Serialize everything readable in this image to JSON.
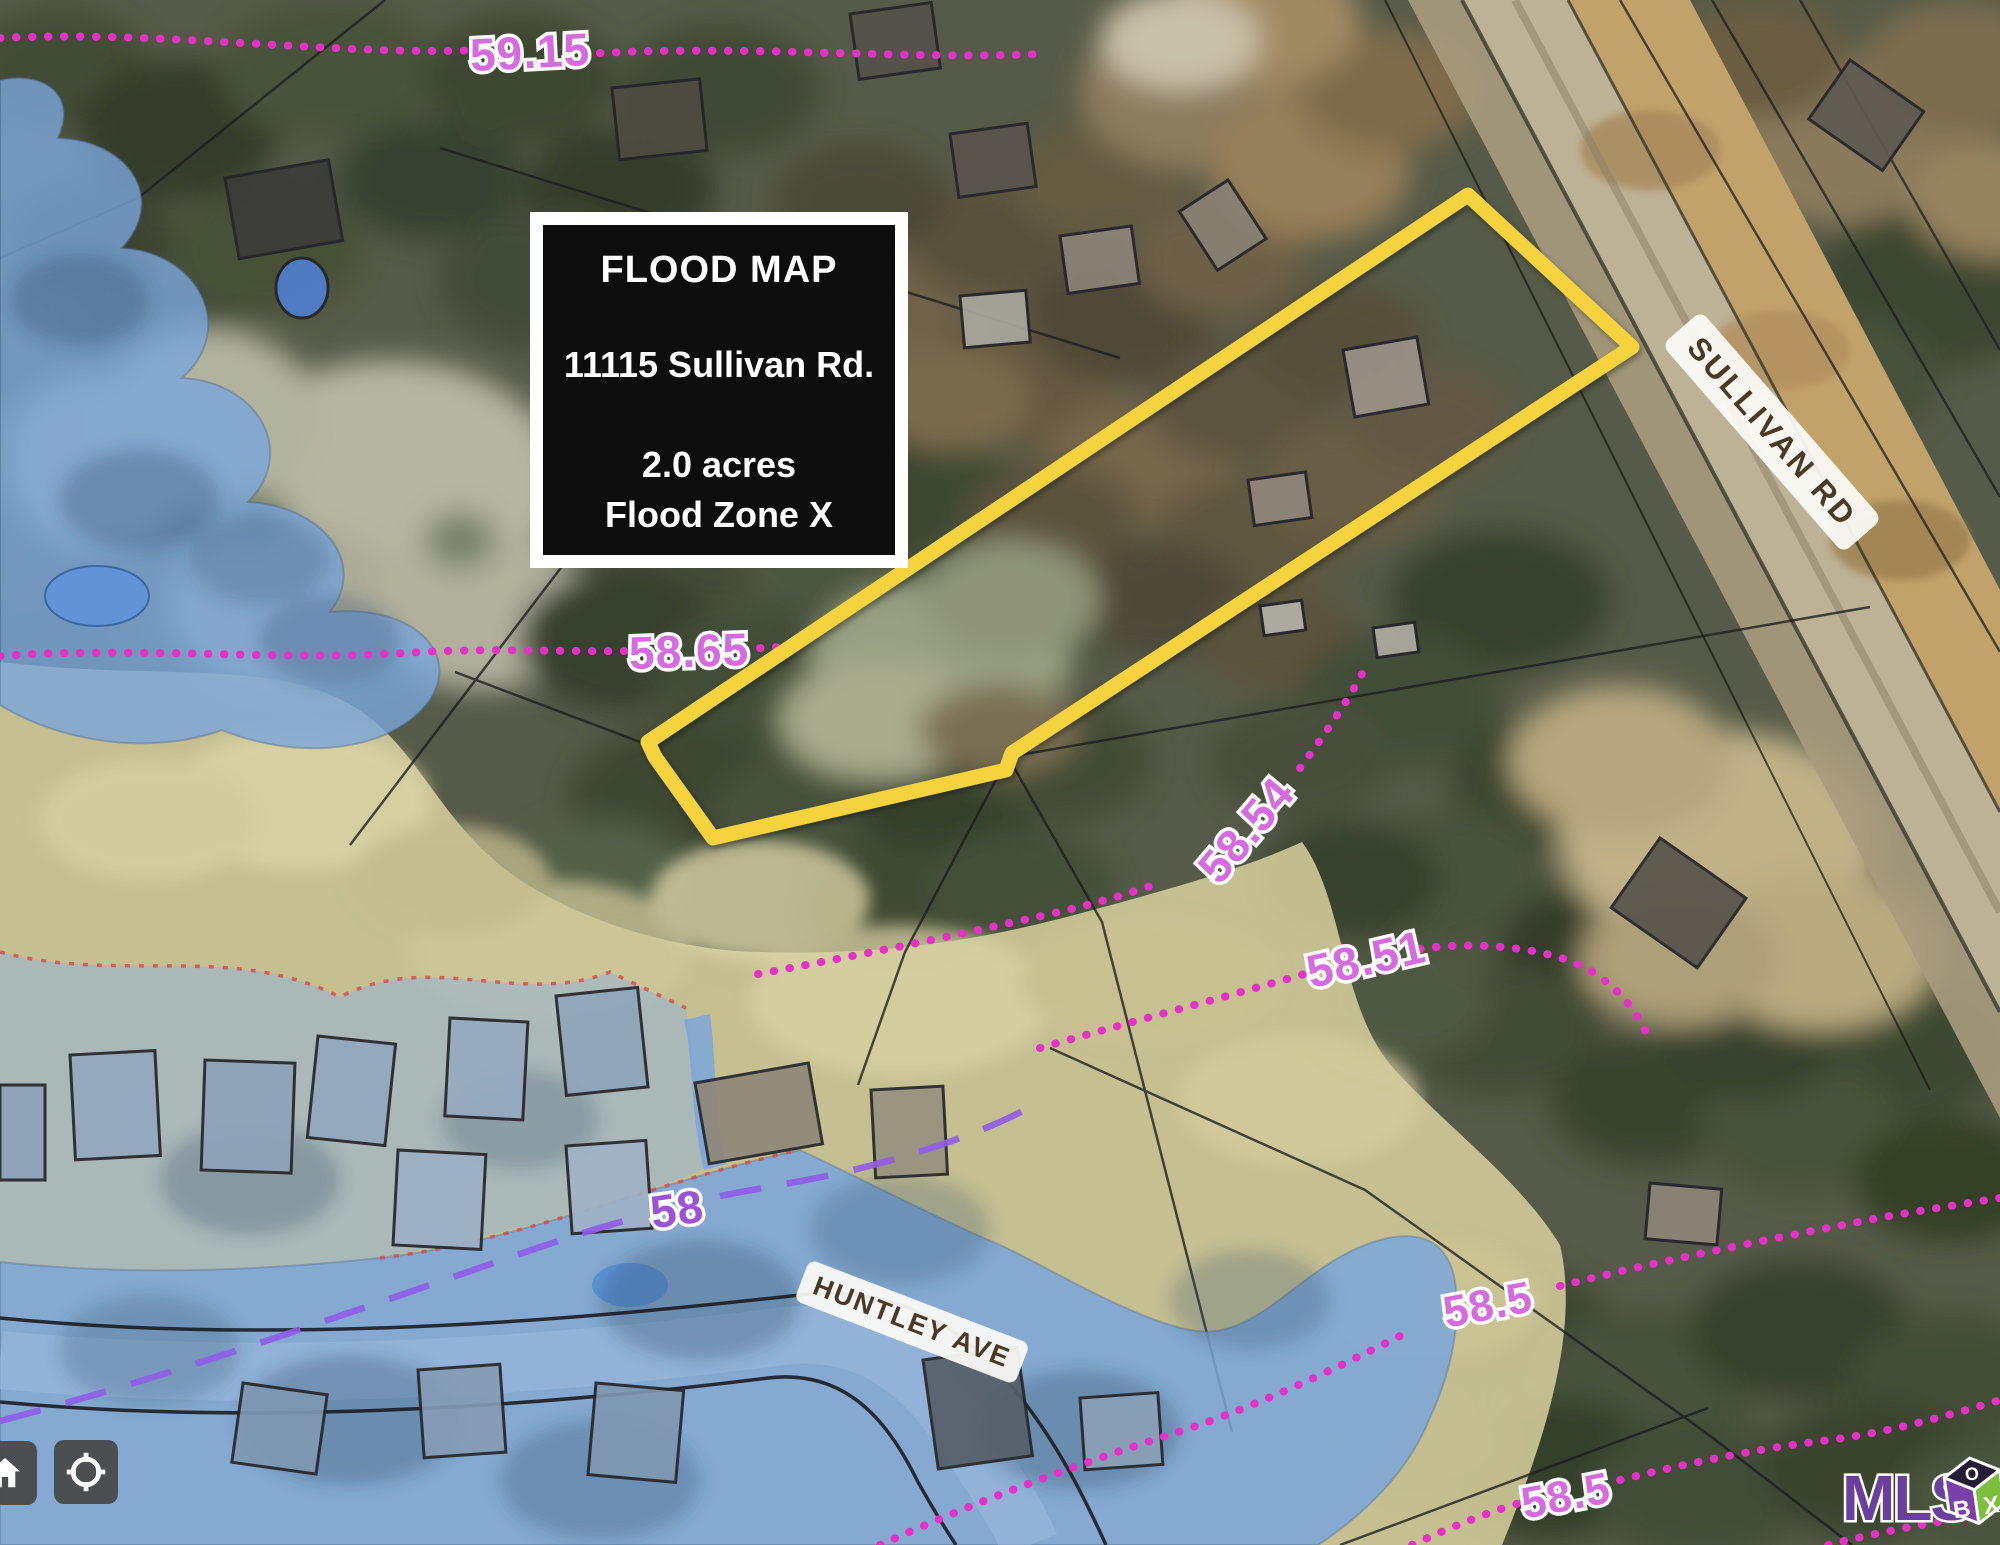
{
  "info_box": {
    "title": "FLOOD MAP",
    "address": "11115 Sullivan Rd.",
    "acres": "2.0 acres",
    "zone": "Flood Zone X"
  },
  "roads": {
    "sullivan": "SULLIVAN RD",
    "huntley": "HUNTLEY AVE"
  },
  "contours": {
    "c59_15": "59.15",
    "c58_65": "58.65",
    "c58_54": "58.54",
    "c58_51": "58.51",
    "c58_5_right": "58.5",
    "c58_5_bottom": "58.5",
    "c58": "58"
  },
  "logo": {
    "text": "MLS",
    "cube_top": "O",
    "cube_left": "B",
    "cube_right": "X"
  },
  "colors": {
    "boundary_yellow": "#F5D33F",
    "contour_magenta": "#E531C8",
    "contour_label_pink": "#D66BE0",
    "contour_label_purple": "#9E52D8",
    "bfe_dashed_purple": "#8F5CE8",
    "flood_blue": "#7BA6DB",
    "zone_shade_khaki": "#D5CD9C",
    "info_box_bg": "#0D0D0D"
  }
}
